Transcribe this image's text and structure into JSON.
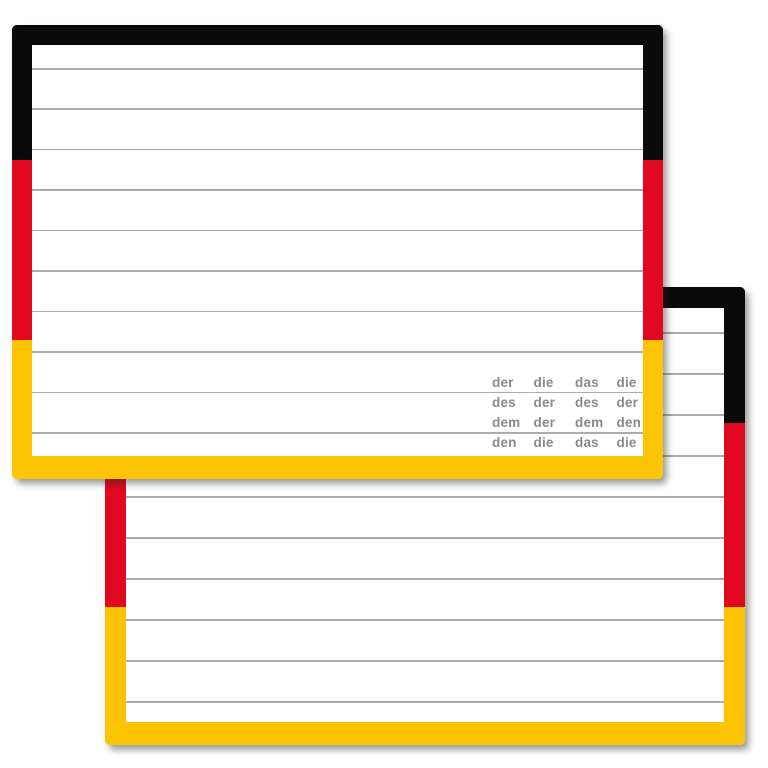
{
  "colors": {
    "page_bg": "#ffffff",
    "card_bg": "#ffffff",
    "flag_black": "#0a0a0a",
    "flag_red": "#e20822",
    "flag_gold": "#fdc404",
    "rule_line": "#ababab",
    "table_text": "#8a8a8a"
  },
  "cards": {
    "back": {
      "ruled_lines": 10
    },
    "front": {
      "ruled_lines": 10,
      "article_table": {
        "rows": [
          [
            "der",
            "die",
            "das",
            "die"
          ],
          [
            "des",
            "der",
            "des",
            "der"
          ],
          [
            "dem",
            "der",
            "dem",
            "den"
          ],
          [
            "den",
            "die",
            "das",
            "die"
          ]
        ]
      }
    }
  }
}
